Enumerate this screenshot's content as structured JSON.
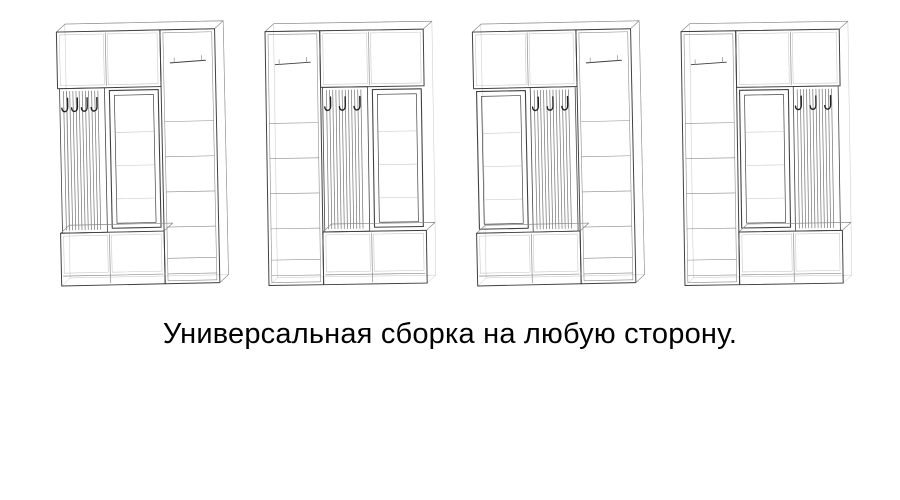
{
  "caption": {
    "text": "Универсальная сборка на любую сторону."
  },
  "colors": {
    "background": "#ffffff",
    "outline": "#3f3f3f",
    "light": "#8a8a8a",
    "faint": "#c4c4c4",
    "slat": "#6f6f6f",
    "hook": "#1f1f1f",
    "text": "#000000"
  },
  "figures": [
    {
      "id": "variant-1",
      "order": [
        "hooks",
        "mirror",
        "wardrobe"
      ],
      "hooks": 4,
      "tilt": -1.2
    },
    {
      "id": "variant-2",
      "order": [
        "wardrobe",
        "hooks",
        "mirror"
      ],
      "hooks": 3,
      "tilt": -0.9
    },
    {
      "id": "variant-3",
      "order": [
        "mirror",
        "hooks",
        "wardrobe"
      ],
      "hooks": 3,
      "tilt": -1.2
    },
    {
      "id": "variant-4",
      "order": [
        "wardrobe",
        "mirror",
        "hooks"
      ],
      "hooks": 3,
      "tilt": -0.9
    }
  ]
}
